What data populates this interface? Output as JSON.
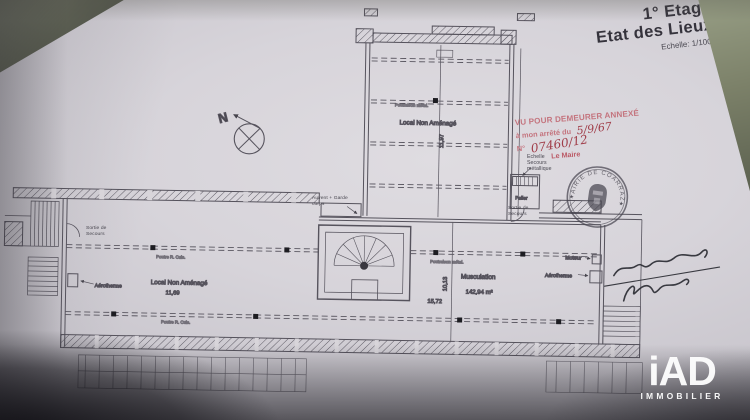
{
  "title_block": {
    "line1": "1° Etage",
    "line2": "Etat des Lieux",
    "scale": "Echelle: 1/100°"
  },
  "red_stamp": {
    "line1": "VU POUR DEMEURER ANNEXÉ",
    "line2_label": "à mon arrêté du",
    "line2_value": "5/9/67",
    "line3_label": "N°",
    "line3_value": "07460/12",
    "signoff": "Le Maire"
  },
  "seal": {
    "arc_text": "MAIRIE DE COARRAZE",
    "star_left": "★",
    "star_right": "★"
  },
  "compass": {
    "north": "N"
  },
  "rooms": {
    "upper_name": "Local Non Aménagé",
    "left_name": "Local Non Aménagé",
    "main_name": "Musculation",
    "main_area": "142,94 m²"
  },
  "dims": {
    "upper_v": "11,97",
    "left_w": "11,69",
    "main_w": "15,72",
    "main_v": "10,13"
  },
  "labels": {
    "ladder": "Echelle Secours métallique",
    "landing": "Palier",
    "exit_upper": "Sortie de Secours",
    "exit_left": "Sortie de Secours",
    "canopy": "Auvent + Garde corps",
    "heater_left": "Aérotherme",
    "heater_right": "Aérotherme",
    "motor": "Moteur",
    "beam_row1": "Poutre R. Cuis.",
    "beam_row2": "Poutre R. Cuis.",
    "beam_main": "Poutraison métal.",
    "beam_upper": "Poutraison métal."
  },
  "watermark": {
    "brand": "iAD",
    "subtitle": "IMMOBILIER"
  }
}
